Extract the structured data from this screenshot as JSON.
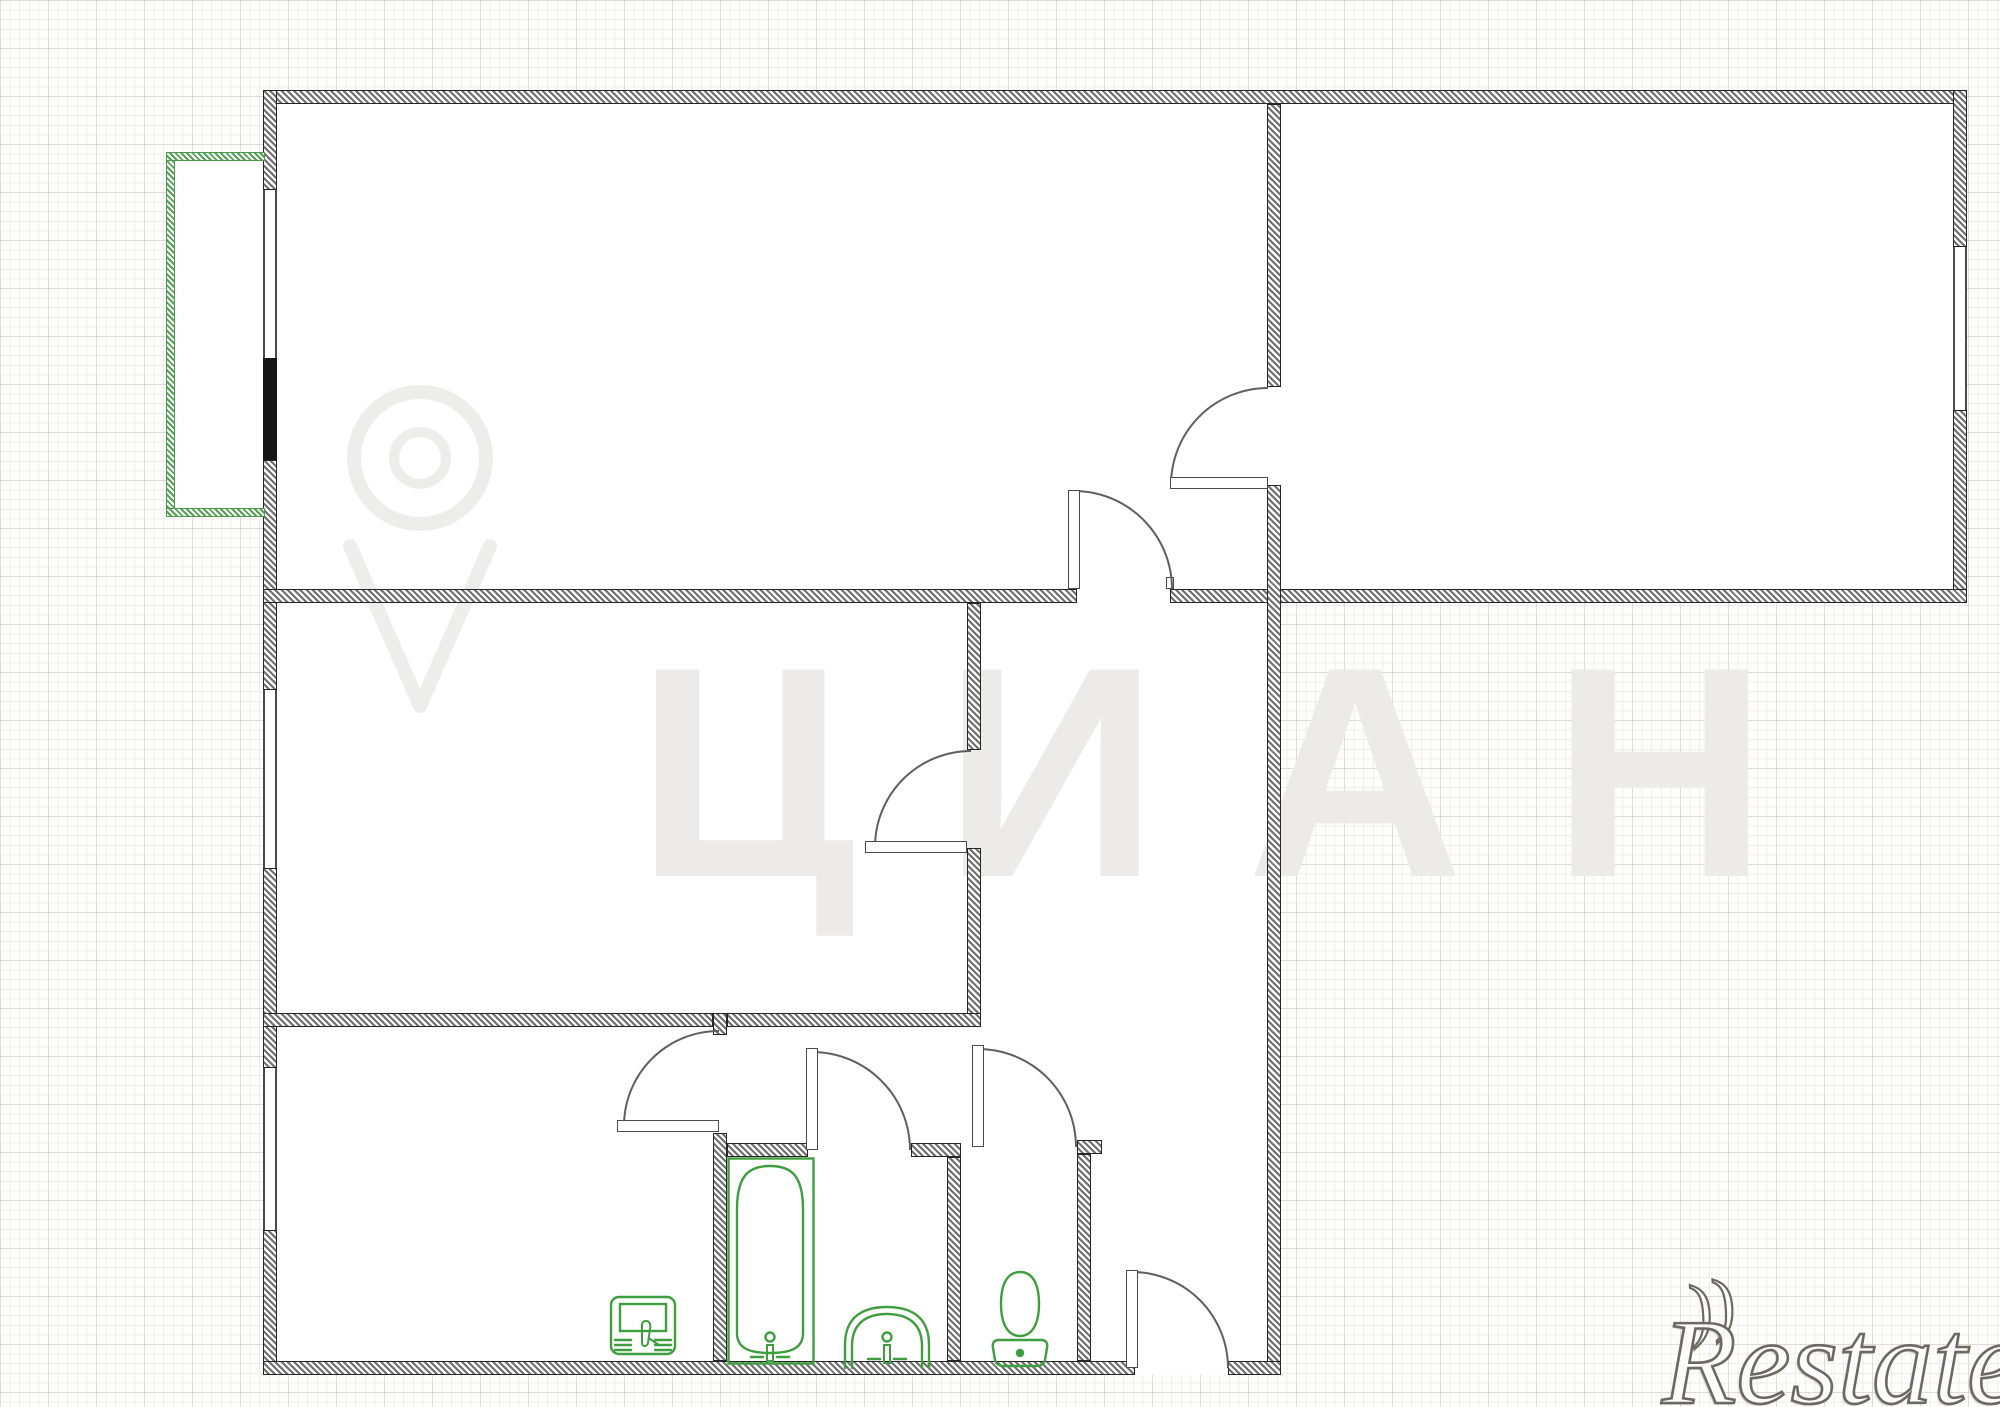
{
  "watermarks": {
    "brand_letters": "ЦИАН",
    "brand_name": "Restate",
    "brand_flourish": "))"
  },
  "colors": {
    "fixture_green": "#3f9e3f",
    "balcony_green": "#57a057",
    "wall_hatch_gray": "#6f6f6f",
    "wall_border": "#262626",
    "balcony_door_black": "#151515",
    "grid_minor": "#e9e5e3",
    "grid_major": "#d6d1cf",
    "watermark_gray": "#edeaea"
  },
  "plan": {
    "type": "apartment-floor-plan",
    "fixtures": [
      "washing-machine-icon",
      "bathtub-icon",
      "sink-icon",
      "toilet-icon"
    ],
    "door_count": 7,
    "window_count": 4,
    "has_balcony": true
  }
}
